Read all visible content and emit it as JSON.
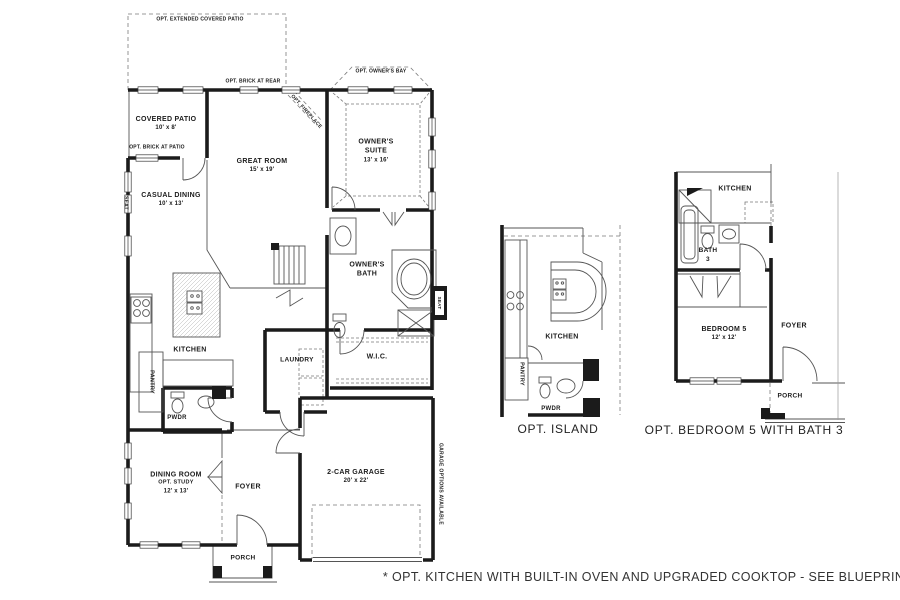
{
  "main": {
    "ext_patio": "OPT. EXTENDED COVERED PATIO",
    "brick_rear": "OPT. BRICK AT REAR",
    "owners_bay": "OPT. OWNER'S BAY",
    "covered_patio": {
      "name": "COVERED PATIO",
      "dim": "10' x 8'"
    },
    "brick_patio": "OPT. BRICK AT PATIO",
    "great_room": {
      "name": "GREAT ROOM",
      "dim": "15' x 19'"
    },
    "fireplace": "OPT. FIREPLACE",
    "owners_suite": {
      "l1": "OWNER'S",
      "l2": "SUITE",
      "dim": "13' x 16'"
    },
    "casual_dining": {
      "name": "CASUAL DINING",
      "dim": "10' x 13'"
    },
    "seat1": "SEAT",
    "kitchen": "KITCHEN",
    "pantry": "PANTRY",
    "pwdr": "PWDR",
    "laundry": "LAUNDRY",
    "owners_bath": {
      "l1": "OWNER'S",
      "l2": "BATH"
    },
    "wic": "W.I.C.",
    "seat2": "SEAT",
    "dining": {
      "name": "DINING ROOM",
      "opt": "OPT. STUDY",
      "dim": "12' x 13'"
    },
    "foyer": "FOYER",
    "garage": {
      "name": "2-CAR GARAGE",
      "dim": "20' x 22'"
    },
    "porch": "PORCH",
    "garage_note": "GARAGE OPTIONS AVAILABLE"
  },
  "island": {
    "kitchen": "KITCHEN",
    "pantry": "PANTRY",
    "pwdr": "PWDR",
    "caption": "OPT. ISLAND"
  },
  "bed5": {
    "kitchen": "KITCHEN",
    "bath_l1": "BATH",
    "bath_l2": "3",
    "bedroom": {
      "name": "BEDROOM 5",
      "dim": "12' x 12'"
    },
    "foyer": "FOYER",
    "porch": "PORCH",
    "caption": "OPT. BEDROOM 5 WITH BATH 3"
  },
  "footnote": "* OPT. KITCHEN WITH BUILT-IN OVEN AND UPGRADED COOKTOP - SEE BLUEPRINTS"
}
